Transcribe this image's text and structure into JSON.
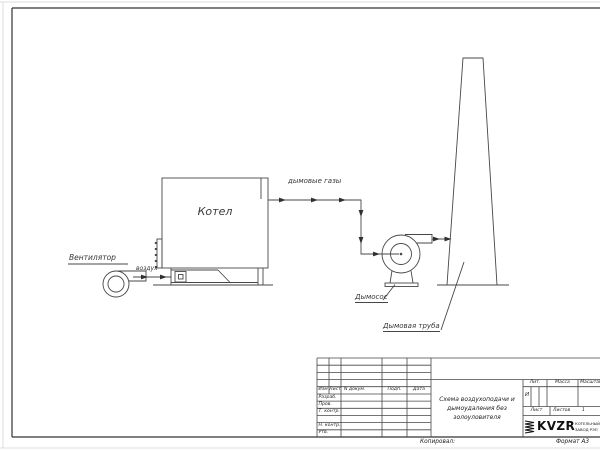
{
  "diagram": {
    "fan_label": "Вентилятор",
    "air_label": "воздух",
    "boiler_label": "Котел",
    "flue_gas_label": "дымовые газы",
    "exhauster_label": "Дымосос",
    "chimney_label": "Дымовая труба"
  },
  "title_block": {
    "columns": {
      "izm": "Изм",
      "list": "Лист",
      "n_dokum": "N докум.",
      "podp": "Подп.",
      "data": "Дата"
    },
    "rows": {
      "razrab": "Разраб.",
      "prov": "Пров.",
      "t_kontr": "Т. контр.",
      "n_kontr": "Н. контр.",
      "utv": "Утв."
    },
    "doc_title": "Схема воздухоподачи и дымоудаления без золоуловителя",
    "lit_label": "Лит.",
    "lit_value": "И",
    "massa_label": "Масса",
    "masshtab_label": "Масштаб",
    "list_label": "Лист",
    "listov_label": "Листов",
    "listov_value": "1",
    "logo_text": "KVZR",
    "company_name_line1": "КОТЕЛЬНЫЙ",
    "company_name_line2": "ЗАВОД РЭП"
  },
  "footer": {
    "kopiroval": "Копировал:",
    "format_label": "Формат А3"
  },
  "colors": {
    "line": "#474747",
    "frame": "#333333"
  }
}
